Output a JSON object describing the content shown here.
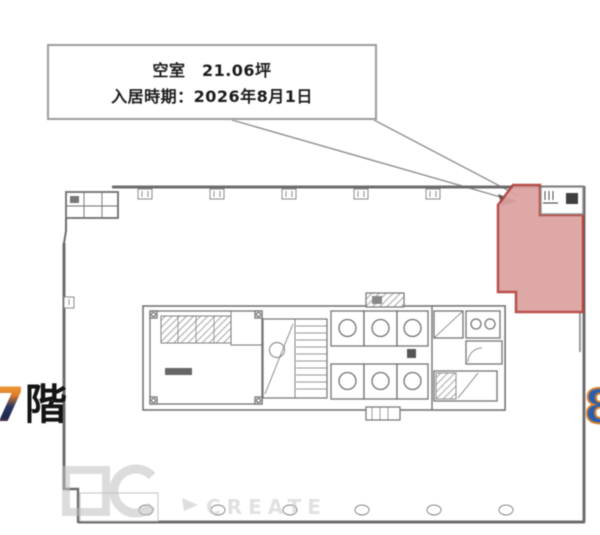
{
  "callout": {
    "area_line": "空室　21.06坪",
    "move_in_line": "入居時期：2026年8月1日"
  },
  "floor_labels": {
    "left_number": "7",
    "left_suffix": "階",
    "right_number": "8"
  },
  "watermark": {
    "text": "CREATE"
  },
  "colors": {
    "highlight_fill": "#dba19f",
    "highlight_border": "#b2423d",
    "wall": "#6d6d6d",
    "left_number_accent_top": "#e8912d",
    "left_number_body": "#2a3763",
    "right_number_fill": "#2b5fae",
    "right_number_outline": "#d9822b"
  }
}
